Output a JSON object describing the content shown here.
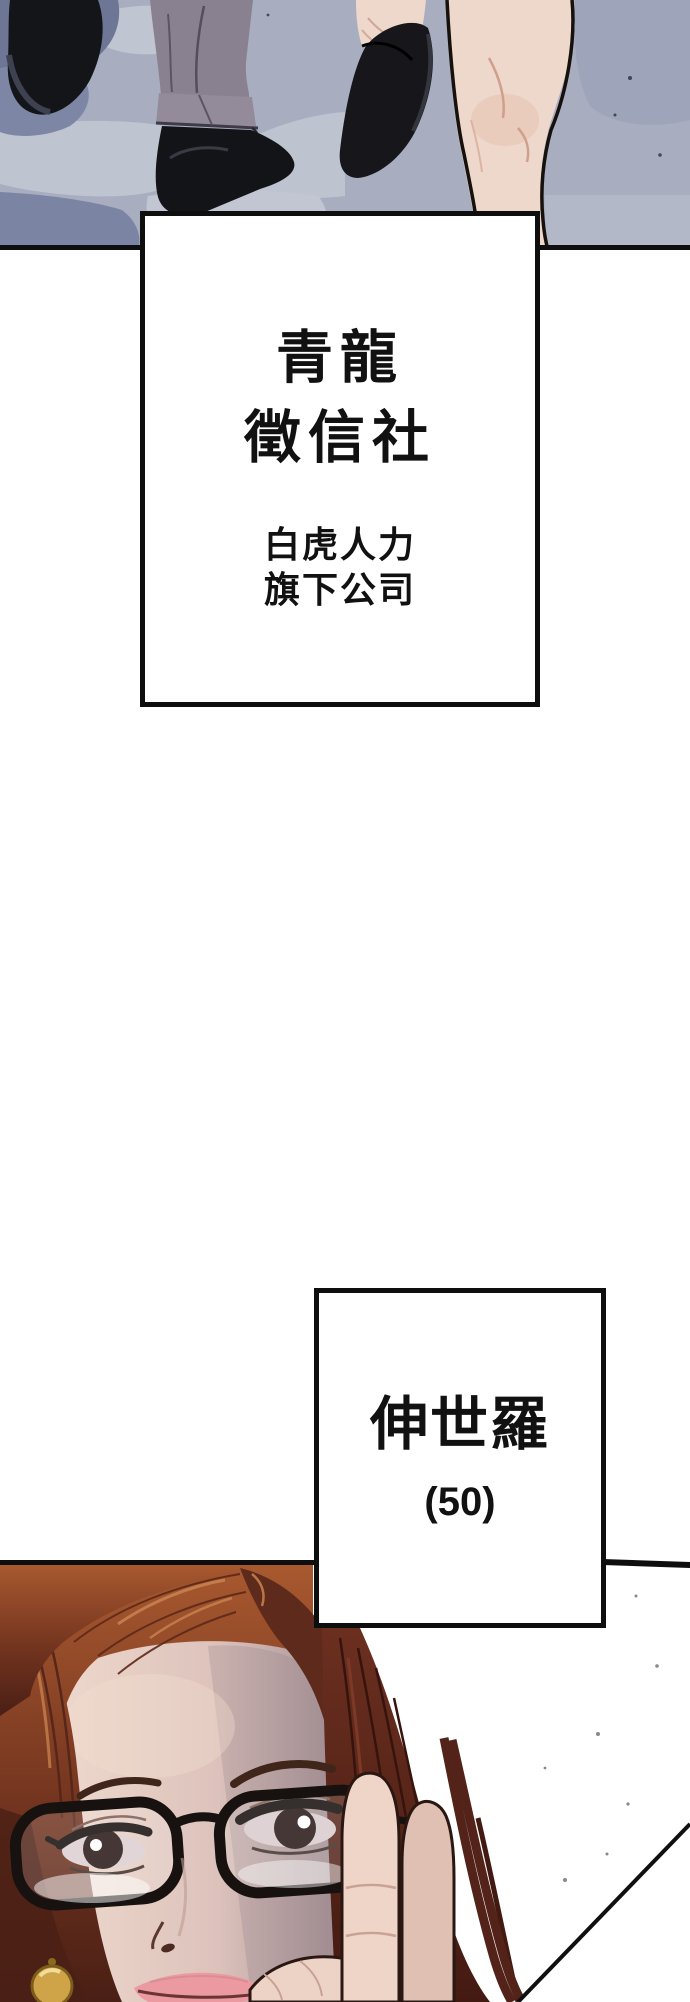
{
  "page": {
    "width": 690,
    "height": 2002,
    "background": "#ffffff"
  },
  "colors": {
    "panel_border": "#0e0e0e",
    "ground_base": "#a8aec0",
    "ground_light": "#c2c6d3",
    "ground_shadow": "#7d87a5",
    "trousers_gray": "#8a8190",
    "shoe_black": "#141519",
    "leg_skin": "#eed7cb",
    "hair_copper": "#a8592f",
    "hair_dark": "#431a12",
    "face_skin": "#eed8cc",
    "face_shadow": "#8d7a82",
    "lips_pink": "#ec9aa2",
    "earring_gold": "#cfa449"
  },
  "top_panel": {
    "description": "Street-level view of a man's legs in gray trousers and black shoes walking beside a woman's bare legs in black flat shoes on blue-gray pavement"
  },
  "sign_box": {
    "title_line1": "青龍",
    "title_line2": "徵信社",
    "subtitle_line1": "白虎人力",
    "subtitle_line2": "旗下公司"
  },
  "character_box": {
    "name": "伸世羅",
    "age": "(50)"
  },
  "bottom_panel": {
    "description": "Close-up portrait of a woman with long copper-brown hair and black rectangular glasses, raising a finger to her glasses"
  }
}
